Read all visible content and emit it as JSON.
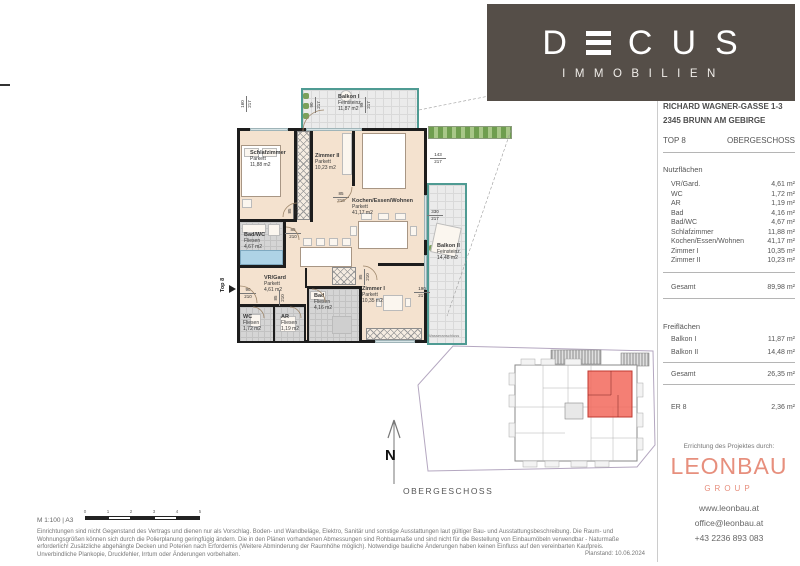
{
  "brand": {
    "word": "DECUS",
    "letters": {
      "d": "D",
      "e": "E",
      "c": "C",
      "u": "U",
      "s": "S"
    },
    "sub": "IMMOBILIEN"
  },
  "project": {
    "address_line1": "RICHARD WAGNER-GASSE 1-3",
    "address_line2": "2345 BRUNN AM GEBIRGE",
    "unit": "TOP 8",
    "floor": "OBERGESCHOSS"
  },
  "areas": {
    "nutz": {
      "title": "Nutzflächen",
      "rows": [
        {
          "label": "VR/Gard.",
          "value": "4,61 m²"
        },
        {
          "label": "WC",
          "value": "1,72 m²"
        },
        {
          "label": "AR",
          "value": "1,19 m²"
        },
        {
          "label": "Bad",
          "value": "4,16 m²"
        },
        {
          "label": "Bad/WC",
          "value": "4,67 m²"
        },
        {
          "label": "Schlafzimmer",
          "value": "11,88 m²"
        },
        {
          "label": "Kochen/Essen/Wohnen",
          "value": "41,17 m²"
        },
        {
          "label": "Zimmer I",
          "value": "10,35 m²"
        },
        {
          "label": "Zimmer II",
          "value": "10,23 m²"
        }
      ],
      "total": {
        "label": "Gesamt",
        "value": "89,98 m²"
      }
    },
    "frei": {
      "title": "Freiflächen",
      "rows": [
        {
          "label": "Balkon I",
          "value": "11,87 m²"
        },
        {
          "label": "Balkon II",
          "value": "14,48 m²"
        }
      ],
      "total": {
        "label": "Gesamt",
        "value": "26,35 m²"
      }
    },
    "er": {
      "label": "ER 8",
      "value": "2,36 m²"
    }
  },
  "builder": {
    "heading": "Errichtung des Projektes durch:",
    "name": "LEONBAU",
    "group": "GROUP",
    "website": "www.leonbau.at",
    "email": "office@leonbau.at",
    "phone": "+43 2236 893 083"
  },
  "plan": {
    "rooms": [
      {
        "name": "Balkon I",
        "floor": "Feinsteinz.",
        "area": "11,87 m2"
      },
      {
        "name": "Schlafzimmer",
        "floor": "Parkett",
        "area": "11,88 m2"
      },
      {
        "name": "Zimmer II",
        "floor": "Parkett",
        "area": "10,23 m2"
      },
      {
        "name": "Kochen/Essen/Wohnen",
        "floor": "Parkett",
        "area": "41,17 m2"
      },
      {
        "name": "Bad/WC",
        "floor": "Fliesen",
        "area": "4,67 m2"
      },
      {
        "name": "VR/Gard",
        "floor": "Parkett",
        "area": "4,61 m2"
      },
      {
        "name": "WC",
        "floor": "Fliesen",
        "area": "1,72 m2"
      },
      {
        "name": "AR",
        "floor": "Fliesen",
        "area": "1,19 m2"
      },
      {
        "name": "Bad",
        "floor": "Fliesen",
        "area": "4,16 m2"
      },
      {
        "name": "Zimmer I",
        "floor": "Parkett",
        "area": "10,35 m2"
      },
      {
        "name": "Balkon II",
        "floor": "Feinsteinz.",
        "area": "14,48 m2"
      }
    ],
    "entry": "Top 8",
    "north": "N",
    "water": "Wasseranschluss",
    "minimap_label": "OBERGESCHOSS",
    "meas": [
      {
        "a": "160",
        "b": "217"
      },
      {
        "a": "90",
        "b": "217"
      },
      {
        "a": "95",
        "b": "217"
      },
      {
        "a": "85",
        "b": "210"
      },
      {
        "a": "85",
        "b": "210"
      },
      {
        "a": "85",
        "b": "210"
      },
      {
        "a": "90",
        "b": "210"
      },
      {
        "a": "85",
        "b": "210"
      },
      {
        "a": "143",
        "b": "217"
      },
      {
        "a": "330",
        "b": "217"
      },
      {
        "a": "190",
        "b": "217"
      },
      {
        "a": "85",
        "b": "210"
      }
    ]
  },
  "footer": {
    "scale": "M 1:100 | A3",
    "ticks": [
      "0",
      "1",
      "2",
      "3",
      "4",
      "5"
    ],
    "lines": [
      "Einrichtungen sind nicht Gegenstand des Vertrags und dienen nur als Vorschlag. Boden- und Wandbeläge, Elektro, Sanitär und sonstige Ausstattungen laut gültiger Bau- und Ausstattungsbeschreibung. Die Raum- und",
      "Wohnungsgrößen können sich durch die Polierplanung geringfügig ändern. Die in den Plänen vorhandenen Abmessungen sind Rohbaumaße und sind nicht für die Bestellung von Einbaumöbeln verwendbar - Naturmaße",
      "erforderlich! Zusätzliche abgehängte Decken und Poterien nach Erfordernis (Weitere Abminderung der Raumhöhe möglich). Notwendige bauliche Änderungen haben keinen Einfluss auf den vereinbarten Kaufpreis.",
      "Unverbindliche Plankopie, Druckfehler, Irrtum oder Änderungen vorbehalten."
    ],
    "planstand": "Planstand: 10.06.2024"
  },
  "colors": {
    "banner": "#554e48",
    "leonbau": "#e78f7d",
    "balcony_border": "#4f9b93",
    "floor_parquet": "#f4e2cf",
    "highlight_unit": "#f2685c"
  }
}
